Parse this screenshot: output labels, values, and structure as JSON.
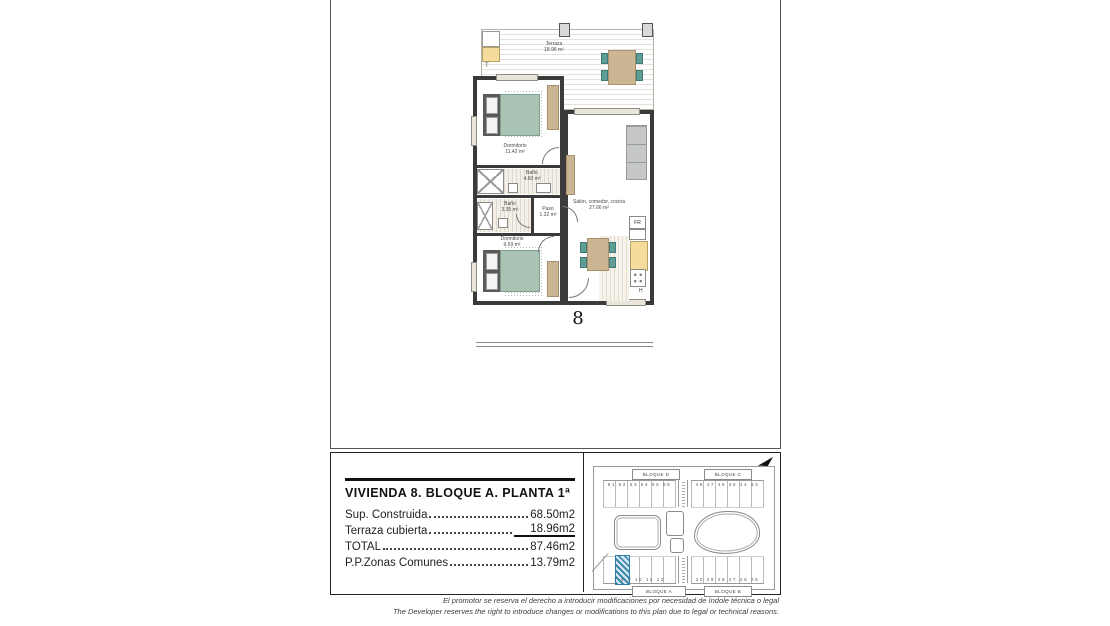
{
  "floor_plan": {
    "terrace": {
      "name": "Terraza",
      "area": "18.96 m²",
      "marker": "T"
    },
    "bedroom1": {
      "name": "Dormitorio",
      "area": "11.42 m²"
    },
    "bath1": {
      "name": "Baño",
      "area": "4.60 m²"
    },
    "bath2": {
      "name": "Baño",
      "area": "3.35 m²"
    },
    "hall": {
      "name": "Paso",
      "area": "1.32 m²"
    },
    "bedroom2": {
      "name": "Dormitorio",
      "area": "9.59 m²"
    },
    "living": {
      "name": "Salón, comedor, cocina",
      "area": "27.66 m²"
    },
    "fridge_label": "FR",
    "hob_label": "H",
    "unit_number": "8"
  },
  "title_block": {
    "title": "VIVIENDA 8. BLOQUE A. PLANTA 1ª",
    "rows": [
      {
        "label": "Sup. Construida",
        "value": "68.50m2"
      },
      {
        "label": "Terraza cubierta",
        "value": "18.96m2"
      },
      {
        "label": "TOTAL",
        "value": "87.46m2"
      },
      {
        "label": "P.P.Zonas Comunes",
        "value": "13.79m2"
      }
    ]
  },
  "site_plan": {
    "block_top_left": "BLOQUE D",
    "block_top_right": "BLOQUE C",
    "block_bottom_left": "BLOQUE A",
    "block_bottom_right": "BLOQUE B",
    "top_left_numbers": "61 62 63 64 65 66",
    "top_right_numbers": "48 47 46 45 44 43",
    "bottom_left_numbers": "7 8 9 10 11 12",
    "bottom_right_numbers": "30 29 28 27 26 25",
    "highlight_color": "#2e7fa8"
  },
  "disclaimer": {
    "line_es": "El promotor se reserva el derecho a introducir modificaciones por necesidad de índole técnica o legal",
    "line_en": "The Developer reserves the right to introduce changes or modifications to this plan due to legal or technical reasons."
  },
  "colors": {
    "wall": "#3a3a3a",
    "bed_green": "#a9c4b4",
    "wood_tan": "#cbb592",
    "counter_yellow": "#f6dc9c",
    "chair_teal": "#5f9e96",
    "highlight_blue": "#2e7fa8"
  }
}
